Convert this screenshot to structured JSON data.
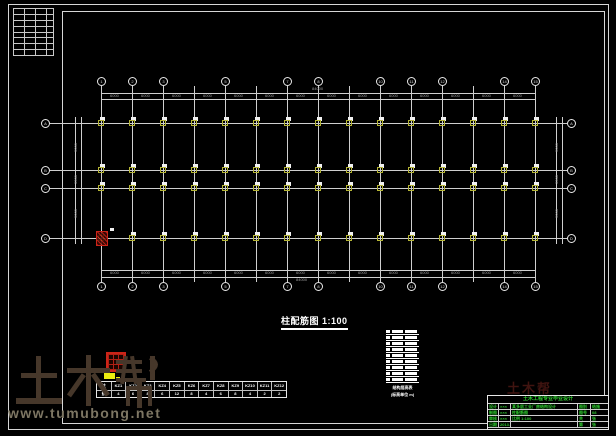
{
  "watermark": {
    "brand": "土木帮",
    "url": "www.tumubong.net"
  },
  "plan": {
    "title": "柱配筋图 1:100",
    "top_axis": {
      "labels": [
        "1",
        "2",
        "3",
        "4",
        "5",
        "6",
        "7",
        "8",
        "9",
        "10",
        "11",
        "12",
        "13",
        "14",
        "15"
      ],
      "bubbled": [
        0,
        1,
        2,
        4,
        6,
        7,
        9,
        10,
        11,
        13,
        14
      ]
    },
    "side_axis": {
      "labels": [
        "A",
        "B",
        "C",
        "D"
      ]
    },
    "dims_top": {
      "segments": [
        "6000",
        "6000",
        "6000",
        "6000",
        "6000",
        "6000",
        "6000",
        "6000",
        "6000",
        "6000",
        "6000",
        "6000",
        "6000",
        "6000"
      ],
      "overall": "84000"
    },
    "dims_bottom": {
      "segments": [
        "6000",
        "6000",
        "6000",
        "6000",
        "6000",
        "6000",
        "6000",
        "6000",
        "6000",
        "6000",
        "6000",
        "6000",
        "6000",
        "6000"
      ],
      "overall": "84000"
    },
    "dims_left": {
      "segments": [
        "9000",
        "3300",
        "9000"
      ],
      "overall": "21300"
    },
    "dims_right": {
      "segments": [
        "9000",
        "3300",
        "9000"
      ],
      "overall": "21300"
    }
  },
  "schedule": {
    "header": [
      "层",
      "标高",
      "层高"
    ],
    "rows": [
      [
        "7",
        "24.95",
        "3.6"
      ],
      [
        "6",
        "21.35",
        "3.6"
      ],
      [
        "5",
        "17.75",
        "3.6"
      ],
      [
        "4",
        "14.15",
        "3.6"
      ],
      [
        "3",
        "10.55",
        "3.6"
      ],
      [
        "2",
        "6.95",
        "3.6"
      ],
      [
        "1",
        "3.35",
        "3.6"
      ],
      [
        "-1",
        "-0.25",
        "3.6"
      ]
    ],
    "caption_line1": "结构层高表",
    "caption_line2": "(标高单位 m)"
  },
  "legend": {
    "row1": [
      "柱",
      "KZ1",
      "KZ2",
      "KZ3",
      "KZ4",
      "KZ5",
      "KZ6",
      "KZ7",
      "KZ8",
      "KZ9",
      "KZ10",
      "KZ11",
      "KZ12"
    ],
    "row2": [
      "数",
      "4",
      "6",
      "8",
      "6",
      "12",
      "8",
      "4",
      "6",
      "8",
      "4",
      "2",
      "2"
    ]
  },
  "title_block": {
    "header": "土木工程专业毕业设计",
    "rows": [
      {
        "label": "设计",
        "name": "×××",
        "mid": "某多层工业厂房结构设计",
        "k": "图别",
        "v": "结施"
      },
      {
        "label": "制图",
        "name": "×××",
        "mid": "柱配筋图",
        "k": "图号",
        "v": "08"
      },
      {
        "label": "审核",
        "name": "×××",
        "mid": "比例 1:100",
        "k": "共",
        "v": "张"
      },
      {
        "label": "日期",
        "name": "2013.6",
        "mid": "",
        "k": "第",
        "v": "张"
      }
    ]
  },
  "colors": {
    "line": "#cfcfcf",
    "dim_text": "#9a9a9a",
    "column_fill": "#f2f2f2",
    "column_outline": "#b5b535",
    "highlight_red": "#cc2418",
    "titleblock_green": "#2ecc2e",
    "watermark_brown": "#46372a",
    "watermark_url_gray": "#7d7663",
    "ghost_red": "#401410"
  }
}
